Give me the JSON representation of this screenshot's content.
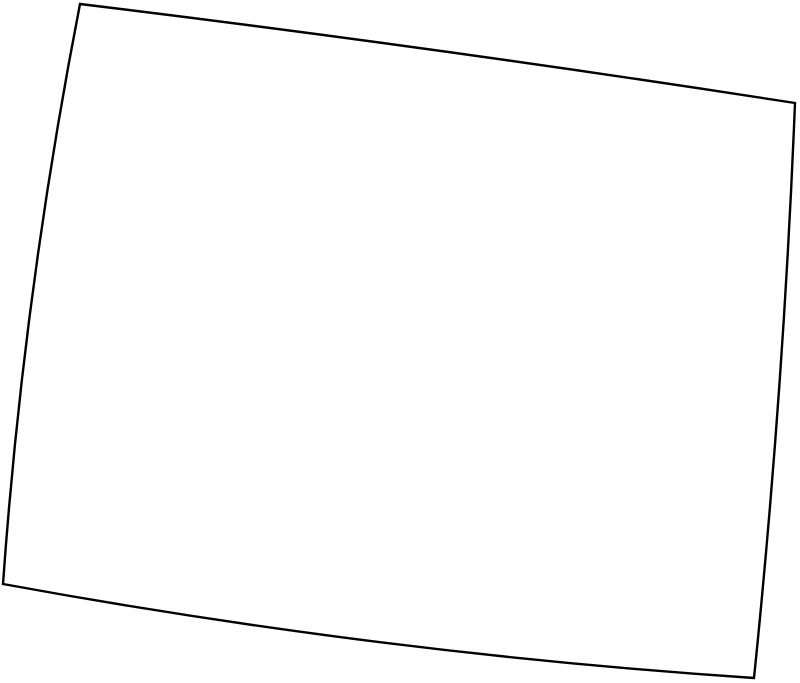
{
  "canvas": {
    "width": 800,
    "height": 683,
    "background_color": "#ffffff"
  },
  "map": {
    "kind": "state-outline",
    "outline": {
      "stroke_color": "#000000",
      "stroke_width": 2.4,
      "fill_color": "#ffffff",
      "start": [
        80,
        4
      ],
      "segments": [
        {
          "type": "Q",
          "control": [
            437.5,
            47.5
          ],
          "end": [
            795,
            103
          ],
          "edge": "north-border"
        },
        {
          "type": "Q",
          "control": [
            783.5,
            390.5
          ],
          "end": [
            754,
            678
          ],
          "edge": "east-border"
        },
        {
          "type": "Q",
          "control": [
            378.5,
            653
          ],
          "end": [
            3,
            584
          ],
          "edge": "south-border"
        },
        {
          "type": "Q",
          "control": [
            23.5,
            294
          ],
          "end": [
            80,
            4
          ],
          "edge": "west-border"
        }
      ],
      "closed": true
    }
  }
}
